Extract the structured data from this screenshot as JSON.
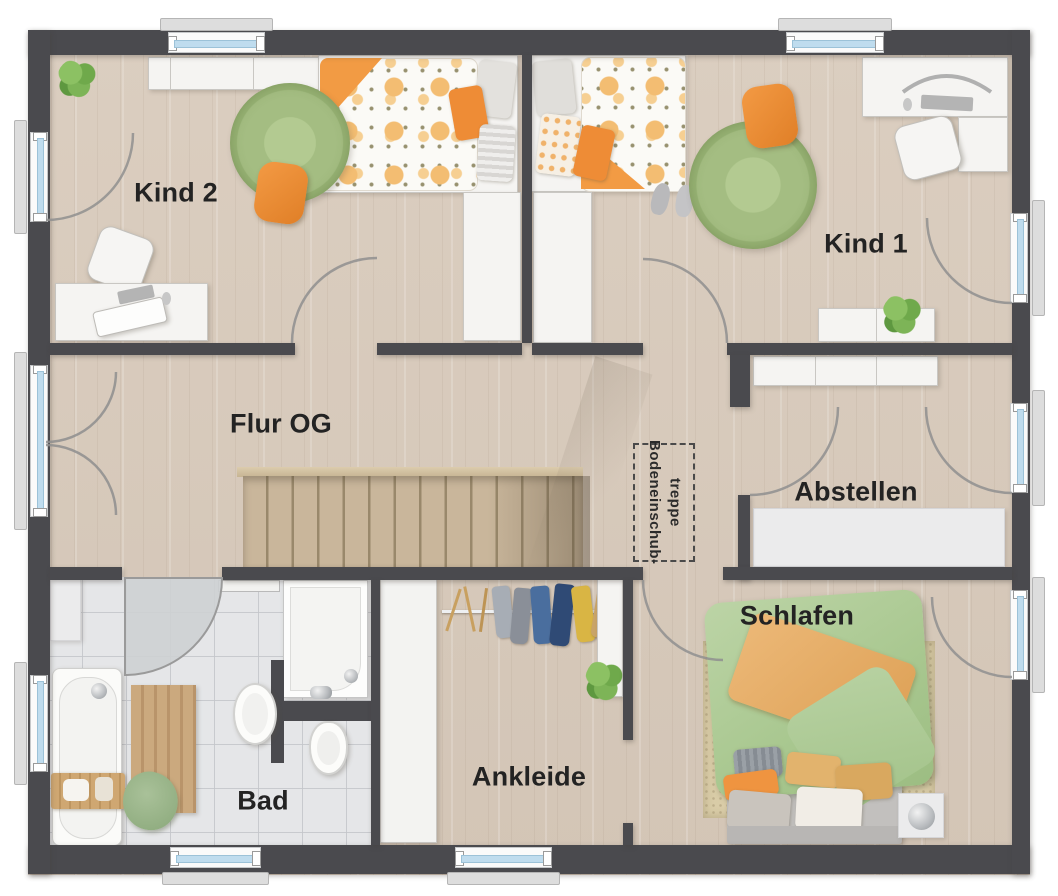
{
  "plan": {
    "type": "floor-plan",
    "floor": "Obergeschoss",
    "rooms": [
      {
        "id": "kind2",
        "label": "Kind 2"
      },
      {
        "id": "kind1",
        "label": "Kind 1"
      },
      {
        "id": "flur_og",
        "label": "Flur OG"
      },
      {
        "id": "abstellen",
        "label": "Abstellen"
      },
      {
        "id": "schlafen",
        "label": "Schlafen"
      },
      {
        "id": "ankleide",
        "label": "Ankleide"
      },
      {
        "id": "bad",
        "label": "Bad"
      }
    ],
    "annotations": {
      "attic_hatch": {
        "label": "Bodeneinschub-treppe",
        "line1": "Bodeneinschub-",
        "line2": "treppe"
      }
    },
    "colors": {
      "wall": "#4a4a4e",
      "floor_wood": "#d7cabc",
      "bath_tile": "#e4e5e7",
      "stair_wood": "#c8b599",
      "accent_orange": "#ee8c36",
      "rug_green": "#a4bd82",
      "duvet_green": "#b5cf9f",
      "window_glass": "#bfdcee",
      "shelf_gray": "#ebebec"
    }
  }
}
